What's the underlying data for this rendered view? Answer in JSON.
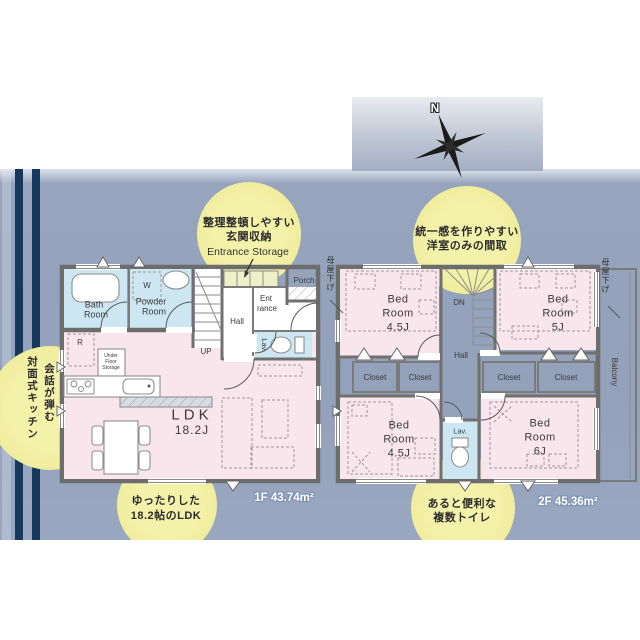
{
  "palette": {
    "band": "#93a1bb",
    "stripe": "#14395c",
    "callout_circle": "#efec9d",
    "room_pink": "#f9e6ed",
    "room_blue": "#cde7f2",
    "closet_yellow": "#eef0c8",
    "wall_gray": "#707070"
  },
  "compass": {
    "north": "N"
  },
  "callouts": {
    "entrance_storage": {
      "jp1": "整理整頓しやすい",
      "jp2": "玄関収納",
      "en": "Entrance Storage"
    },
    "uniform_rooms": {
      "jp1": "統一感を作りやすい",
      "jp2": "洋室のみの間取"
    },
    "open_kitchen": {
      "col_right": "会話が弾む",
      "col_left": "対面式キッチン"
    },
    "spacious_ldk": {
      "jp1": "ゆったりした",
      "jp2": "18.2帖のLDK"
    },
    "multiple_toilets": {
      "jp1": "あると便利な",
      "jp2": "複数トイレ"
    }
  },
  "floor1": {
    "area": "1F 43.74m²",
    "bath": {
      "l1": "Bath",
      "l2": "Room"
    },
    "powder": {
      "l1": "Powder",
      "l2": "Room"
    },
    "washer": "W",
    "fridge": "R",
    "under_floor": {
      "l1": "Under",
      "l2": "Floor",
      "l3": "Storage"
    },
    "hall": "Hall",
    "entrance": {
      "l1": "Ent",
      "l2": "rance"
    },
    "porch": "Porch",
    "lav": "Lav.",
    "up": "UP",
    "ldk": {
      "l1": "LDK",
      "l2": "18.2J"
    }
  },
  "floor2": {
    "area": "2F 45.36m²",
    "dn": "DN",
    "hall": "Hall",
    "lav": "Lav.",
    "closet": "Closet",
    "balcony": "Balcony",
    "eaves": "母屋下げ",
    "bed1": {
      "l1": "Bed",
      "l2": "Room",
      "l3": "4.5J"
    },
    "bed2": {
      "l1": "Bed",
      "l2": "Room",
      "l3": "5J"
    },
    "bed3": {
      "l1": "Bed",
      "l2": "Room",
      "l3": "4.5J"
    },
    "bed4": {
      "l1": "Bed",
      "l2": "Room",
      "l3": "6J"
    }
  }
}
